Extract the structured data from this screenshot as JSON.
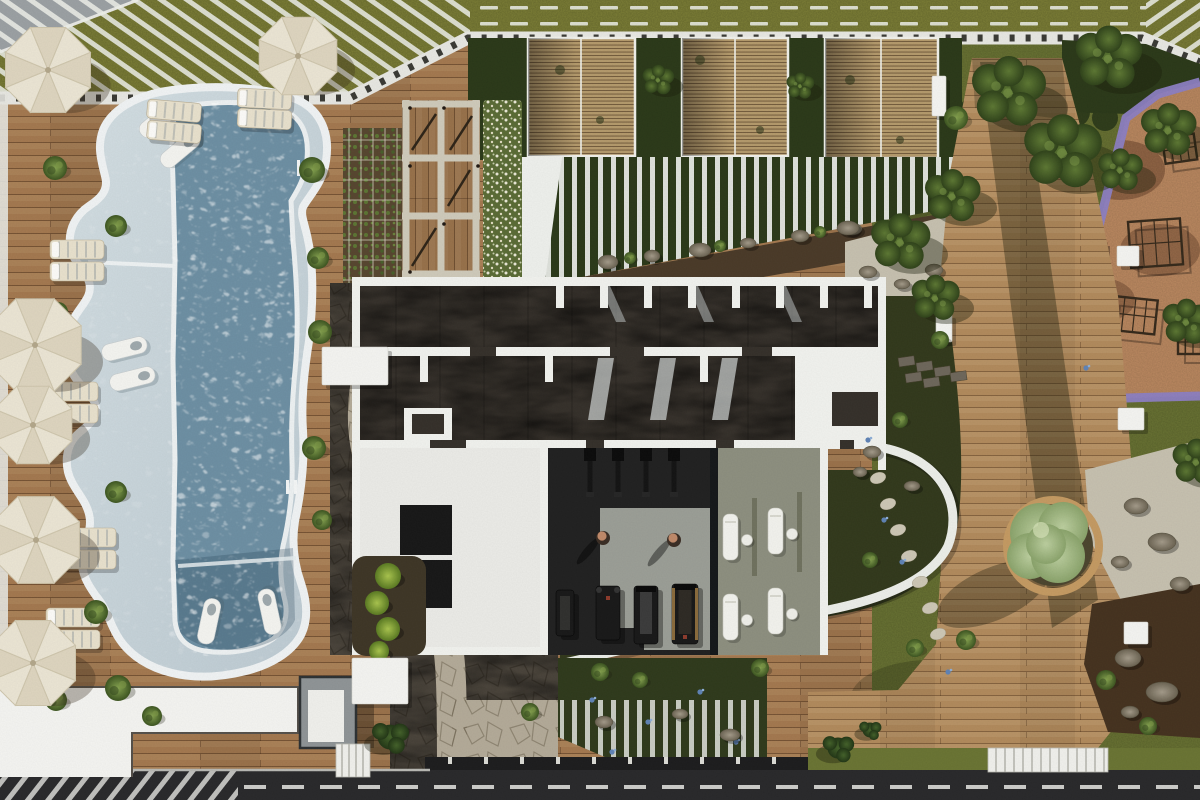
{
  "meta": {
    "canvas_w": 1200,
    "canvas_h": 800,
    "scene": "aerial-architectural-render-pool-amenity"
  },
  "palette": {
    "grass": "#7d7f36",
    "grassDark": "#676a2c",
    "hedge": "#2b3919",
    "lawn": "#6a7433",
    "wood": "#a3784f",
    "woodLine": "#6b4526",
    "woodPath": "#b18a5c",
    "woodSlat": "#b49a6c",
    "walkway": "#e7e7e2",
    "tick": "#3a3a35",
    "rim": "#edf1f2",
    "shallow": "#c6d3d9",
    "deep": "#6d8fa3",
    "deepDark": "#54778c",
    "roof": "#35302a",
    "wall": "#f1f2ee",
    "gymFloor": "#212121",
    "gymMat": "#9b9e96",
    "spaFloor": "#8d8f7f",
    "stoneDark": "#49433a",
    "stoneLight": "#b3aa98",
    "gravel": "#c6c0af",
    "soil": "#4a3a28",
    "mulch": "#45321f",
    "play": "#bd8a61",
    "purple": "#8c7ec2",
    "road": "#29292b",
    "roadMark": "#dededa",
    "fence": "#1d1d1e",
    "white": "#f4f4f1",
    "grayStruct": "#8f9496",
    "umb": "#ebe5d4",
    "umbRib": "#cfc6ad",
    "lounger": "#e8e1cd",
    "loungerStripe": "#9aa0a2",
    "bushDark": "#31451c",
    "skin": "#c08a6a"
  },
  "objects": {
    "umbrellas": [
      [
        48,
        70,
        46
      ],
      [
        298,
        56,
        42
      ],
      [
        35,
        345,
        50
      ],
      [
        33,
        425,
        42
      ],
      [
        36,
        540,
        47
      ],
      [
        33,
        663,
        46
      ]
    ],
    "deck_loungers": [
      [
        148,
        99,
        5
      ],
      [
        148,
        120,
        5
      ],
      [
        238,
        88,
        3
      ],
      [
        238,
        108,
        3
      ],
      [
        50,
        240,
        0
      ],
      [
        50,
        262,
        0
      ],
      [
        44,
        382,
        0
      ],
      [
        44,
        404,
        0
      ],
      [
        62,
        528,
        0
      ],
      [
        62,
        550,
        0
      ],
      [
        46,
        608,
        0
      ],
      [
        46,
        630,
        0
      ]
    ],
    "pool_loungers": [
      [
        136,
        128,
        -40
      ],
      [
        157,
        158,
        -40
      ],
      [
        100,
        346,
        -14
      ],
      [
        108,
        376,
        -14
      ],
      [
        196,
        642,
        -78
      ],
      [
        266,
        636,
        -102
      ]
    ],
    "bushes": [
      [
        312,
        170,
        13
      ],
      [
        55,
        168,
        12
      ],
      [
        116,
        226,
        11
      ],
      [
        58,
        312,
        10
      ],
      [
        318,
        258,
        11
      ],
      [
        320,
        332,
        12
      ],
      [
        314,
        448,
        12
      ],
      [
        322,
        520,
        10
      ],
      [
        116,
        492,
        11
      ],
      [
        96,
        612,
        12
      ],
      [
        118,
        688,
        13
      ],
      [
        56,
        700,
        11
      ],
      [
        152,
        716,
        10
      ],
      [
        956,
        118,
        12
      ],
      [
        966,
        640,
        10
      ],
      [
        600,
        672,
        9
      ],
      [
        640,
        680,
        8
      ],
      [
        760,
        668,
        9
      ],
      [
        915,
        648,
        9
      ],
      [
        1106,
        680,
        10
      ],
      [
        1148,
        726,
        9
      ],
      [
        530,
        712,
        9
      ],
      [
        870,
        560,
        8
      ],
      [
        900,
        420,
        8
      ],
      [
        940,
        340,
        9
      ],
      [
        630,
        258,
        6
      ],
      [
        720,
        246,
        6
      ],
      [
        820,
        232,
        6
      ]
    ],
    "trees": [
      [
        1008,
        92,
        40
      ],
      [
        1062,
        152,
        42
      ],
      [
        1108,
        58,
        36
      ],
      [
        1168,
        130,
        30
      ],
      [
        952,
        196,
        30
      ],
      [
        900,
        242,
        32
      ],
      [
        1186,
        322,
        26
      ],
      [
        935,
        298,
        26
      ],
      [
        1196,
        462,
        26
      ],
      [
        658,
        80,
        17
      ],
      [
        800,
        86,
        15
      ],
      [
        1120,
        170,
        24
      ]
    ],
    "pines": [
      [
        390,
        737,
        20
      ],
      [
        838,
        748,
        17
      ],
      [
        870,
        730,
        12
      ]
    ],
    "sage": {
      "x": 1053,
      "y": 546,
      "benchR": 46,
      "canopy": [
        [
          1040,
          533,
          30
        ],
        [
          1063,
          527,
          25
        ],
        [
          1030,
          556,
          23
        ],
        [
          1058,
          556,
          27
        ],
        [
          1046,
          544,
          20
        ]
      ]
    },
    "white_squares": [
      [
        322,
        347,
        66,
        38
      ],
      [
        352,
        658,
        56,
        46
      ],
      [
        932,
        76,
        14,
        40
      ],
      [
        936,
        314,
        16,
        28
      ],
      [
        1118,
        408,
        26,
        22
      ],
      [
        1124,
        622,
        24,
        22
      ],
      [
        1117,
        246,
        22,
        20
      ]
    ],
    "rocks": [
      [
        608,
        262,
        10,
        7
      ],
      [
        652,
        256,
        8,
        6
      ],
      [
        700,
        250,
        11,
        7
      ],
      [
        748,
        243,
        8,
        5
      ],
      [
        800,
        236,
        9,
        6
      ],
      [
        852,
        229,
        10,
        6
      ],
      [
        898,
        222,
        9,
        6
      ],
      [
        848,
        228,
        11,
        7
      ],
      [
        868,
        272,
        9,
        6
      ],
      [
        902,
        284,
        8,
        5
      ],
      [
        934,
        270,
        9,
        6
      ],
      [
        1136,
        506,
        12,
        8
      ],
      [
        1162,
        542,
        14,
        9
      ],
      [
        1120,
        562,
        9,
        6
      ],
      [
        1180,
        584,
        10,
        7
      ],
      [
        1128,
        658,
        13,
        9
      ],
      [
        1162,
        692,
        16,
        10
      ],
      [
        1130,
        712,
        9,
        6
      ],
      [
        604,
        722,
        9,
        6
      ],
      [
        680,
        714,
        8,
        5
      ],
      [
        730,
        735,
        10,
        6
      ],
      [
        872,
        452,
        9,
        6
      ],
      [
        860,
        472,
        7,
        5
      ],
      [
        912,
        486,
        8,
        5
      ]
    ],
    "stepping_stones": [
      [
        878,
        478
      ],
      [
        888,
        504
      ],
      [
        898,
        530
      ],
      [
        909,
        556
      ],
      [
        920,
        582
      ],
      [
        930,
        608
      ],
      [
        938,
        634
      ]
    ],
    "slabs": [
      [
        898,
        358
      ],
      [
        916,
        363
      ],
      [
        934,
        368
      ],
      [
        950,
        373
      ],
      [
        905,
        374
      ],
      [
        923,
        379
      ]
    ],
    "gym_hang": [
      [
        590
      ],
      [
        618
      ],
      [
        646
      ],
      [
        674
      ]
    ],
    "gym_machines": [
      [
        556,
        590,
        18,
        46,
        "bench"
      ],
      [
        596,
        586,
        24,
        54,
        "cable"
      ],
      [
        634,
        586,
        24,
        58,
        "tread"
      ],
      [
        672,
        584,
        26,
        60,
        "tread2"
      ]
    ],
    "people": [
      [
        603,
        538
      ],
      [
        674,
        540
      ]
    ],
    "spa_loungers": [
      [
        723,
        514
      ],
      [
        768,
        508
      ],
      [
        723,
        594
      ],
      [
        768,
        588
      ]
    ],
    "stools": [
      [
        747,
        540
      ],
      [
        792,
        534
      ],
      [
        747,
        620
      ],
      [
        792,
        614
      ]
    ],
    "play_frames": [
      [
        1128,
        222,
        52,
        46,
        -4
      ],
      [
        1114,
        296,
        44,
        34,
        6
      ],
      [
        1162,
        138,
        32,
        26,
        -8
      ],
      [
        1178,
        330,
        30,
        24,
        0
      ]
    ],
    "play_bench": [
      1092,
      243,
      15,
      34
    ],
    "green_balls": [
      [
        388,
        576,
        13
      ],
      [
        377,
        603,
        12
      ],
      [
        388,
        629,
        12
      ],
      [
        379,
        651,
        10
      ]
    ],
    "hedge_blobs": [
      [
        975,
        112,
        16
      ],
      [
        1010,
        116,
        14
      ],
      [
        1075,
        112,
        15
      ],
      [
        1105,
        118,
        13
      ],
      [
        1140,
        112,
        15
      ],
      [
        1180,
        116,
        14
      ]
    ],
    "lawn_shades": [
      [
        1030,
        420,
        90,
        50
      ],
      [
        930,
        700,
        80,
        40
      ],
      [
        1160,
        240,
        70,
        60
      ],
      [
        900,
        180,
        60,
        40
      ],
      [
        1190,
        700,
        60,
        35
      ]
    ],
    "flowers": [
      [
        592,
        700
      ],
      [
        648,
        722
      ],
      [
        700,
        692
      ],
      [
        736,
        742
      ],
      [
        612,
        752
      ],
      [
        884,
        520
      ],
      [
        902,
        562
      ],
      [
        868,
        440
      ],
      [
        1086,
        368
      ],
      [
        948,
        672
      ]
    ],
    "litter": [
      [
        560,
        70,
        5
      ],
      [
        600,
        120,
        4
      ],
      [
        700,
        60,
        5
      ],
      [
        760,
        130,
        4
      ],
      [
        850,
        80,
        5
      ],
      [
        900,
        140,
        4
      ]
    ]
  }
}
